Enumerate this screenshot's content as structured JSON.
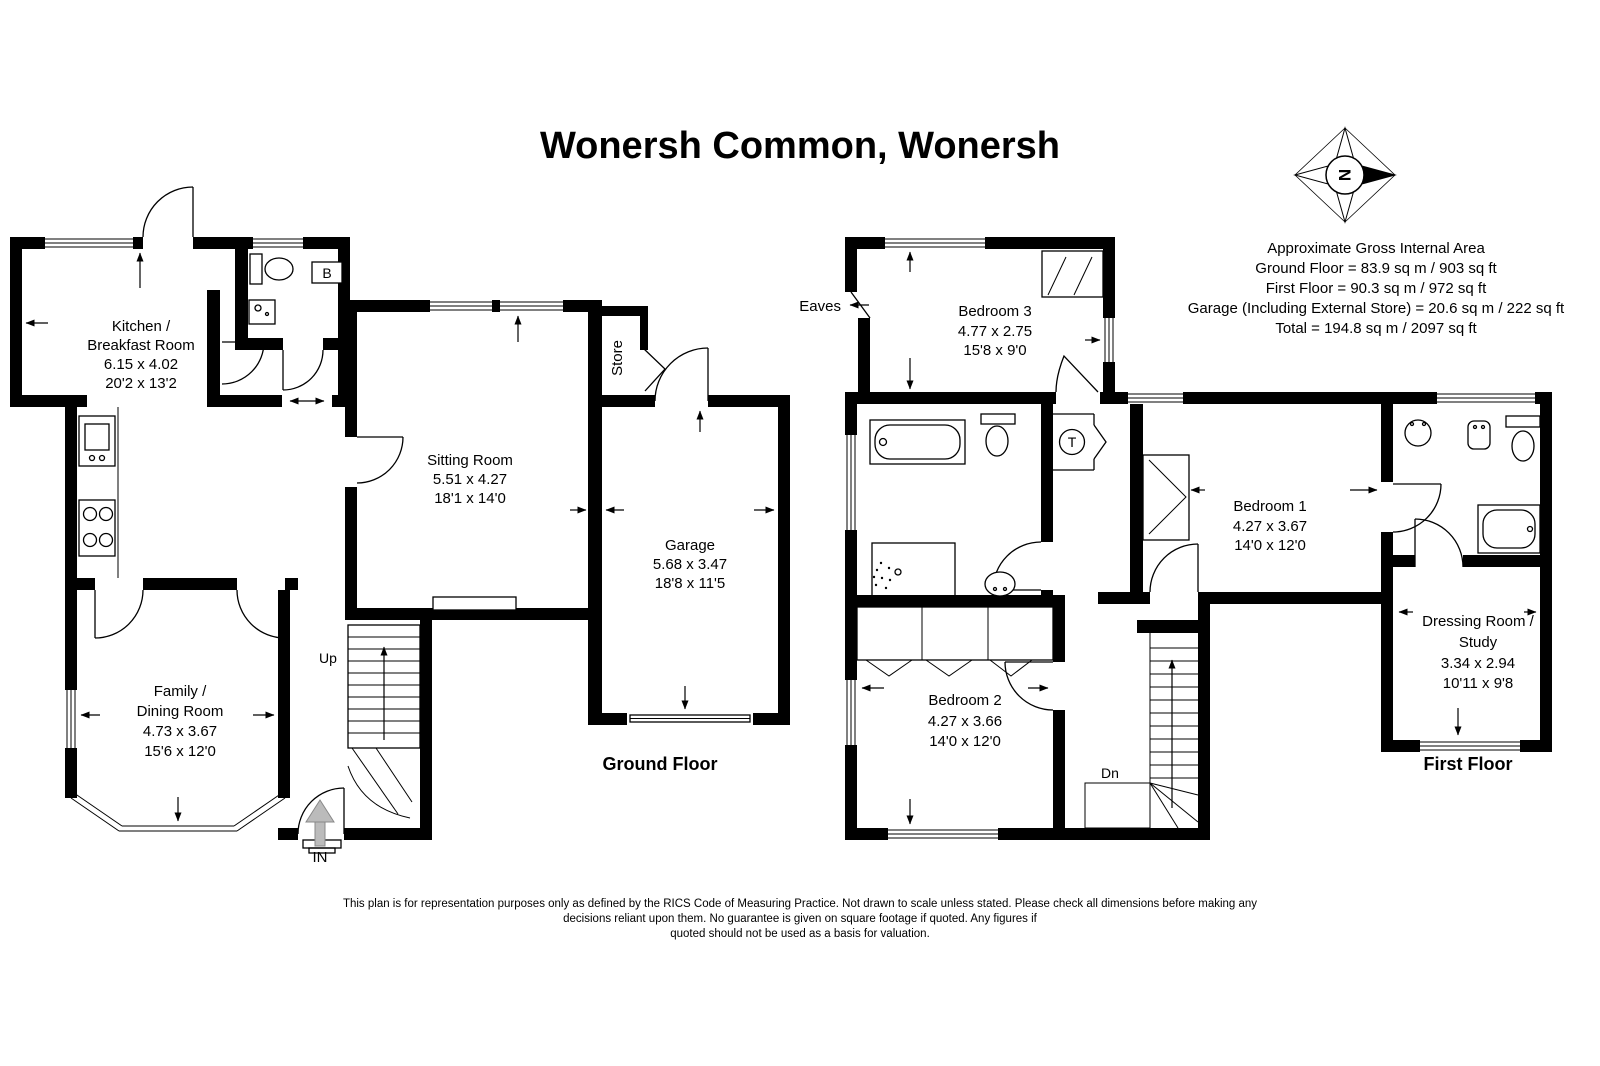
{
  "title": "Wonersh Common, Wonersh",
  "compass": {
    "north": "N"
  },
  "area_summary": {
    "lines": [
      "Approximate Gross Internal Area",
      "Ground Floor = 83.9 sq m / 903 sq ft",
      "First Floor = 90.3 sq m / 972 sq ft",
      "Garage (Including External Store) = 20.6 sq m / 222 sq ft",
      "Total = 194.8 sq m / 2097 sq ft"
    ]
  },
  "ground_floor": {
    "label": "Ground Floor",
    "rooms": {
      "kitchen": {
        "name_line1": "Kitchen /",
        "name_line2": "Breakfast Room",
        "metric": "6.15 x 4.02",
        "imperial": "20'2 x 13'2"
      },
      "sitting": {
        "name_line1": "Sitting Room",
        "metric": "5.51 x 4.27",
        "imperial": "18'1 x 14'0"
      },
      "garage": {
        "name_line1": "Garage",
        "metric": "5.68 x 3.47",
        "imperial": "18'8 x 11'5"
      },
      "family": {
        "name_line1": "Family /",
        "name_line2": "Dining Room",
        "metric": "4.73 x 3.67",
        "imperial": "15'6 x 12'0"
      }
    },
    "annotations": {
      "store": "Store",
      "boiler": "B",
      "up": "Up",
      "entrance": "IN"
    }
  },
  "first_floor": {
    "label": "First Floor",
    "rooms": {
      "bedroom3": {
        "name_line1": "Bedroom 3",
        "metric": "4.77 x 2.75",
        "imperial": "15'8 x 9'0"
      },
      "bedroom1": {
        "name_line1": "Bedroom 1",
        "metric": "4.27 x 3.67",
        "imperial": "14'0 x 12'0"
      },
      "bedroom2": {
        "name_line1": "Bedroom 2",
        "metric": "4.27 x 3.66",
        "imperial": "14'0 x 12'0"
      },
      "dressing": {
        "name_line1": "Dressing Room /",
        "name_line2": "Study",
        "metric": "3.34 x 2.94",
        "imperial": "10'11 x 9'8"
      }
    },
    "annotations": {
      "eaves": "Eaves",
      "down": "Dn",
      "tank": "T"
    }
  },
  "disclaimer": {
    "lines": [
      "This plan is for representation purposes only as defined by the RICS Code of Measuring Practice. Not drawn to scale unless stated. Please check all dimensions before making any",
      "decisions reliant upon them. No guarantee is given on square footage if quoted. Any figures if",
      "quoted should not be used as a basis for valuation."
    ]
  },
  "colors": {
    "wall": "#000000",
    "background": "#ffffff",
    "arrow_gray": "#bbbbbb"
  }
}
